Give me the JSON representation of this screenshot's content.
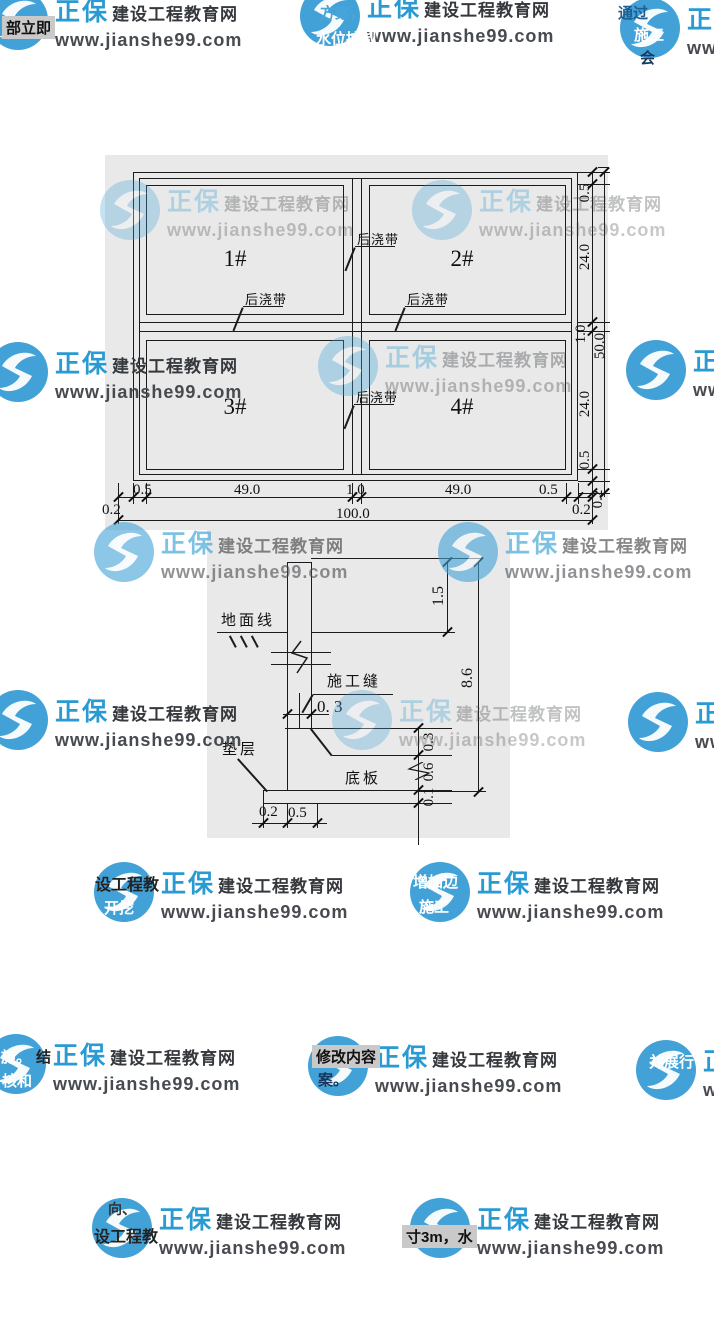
{
  "watermark": {
    "brand": "正保",
    "site": "建设工程教育网",
    "url": "www.jianshe99.com"
  },
  "fragments": {
    "f1": "部立即",
    "f2": "方案，",
    "f3": "水位控制",
    "f4": "通过",
    "f5": "施工",
    "f6": "会",
    "f7": "设工程教",
    "f8": "开挖",
    "f9": "增加边",
    "f10": "施工",
    "f11": "施。",
    "f12": "结",
    "f13": "核和",
    "f14": "修改内容",
    "f15": "案。",
    "f16": "并展行",
    "f17": "向、",
    "f18": "设工程教",
    "f19": "寸3m，水"
  },
  "plan": {
    "quadrants": [
      "1#",
      "2#",
      "3#",
      "4#"
    ],
    "joint_label": "后浇带",
    "dims_bottom": [
      "0.2",
      "0.5",
      "49.0",
      "1.0",
      "49.0",
      "0.5",
      "0.2"
    ],
    "total_bottom": "100.0",
    "dims_right": [
      "0.5",
      "24.0",
      "1.0",
      "24.0",
      "0.5",
      "0.2"
    ],
    "total_right": "50.0"
  },
  "section": {
    "labels": {
      "ground": "地面线",
      "joint": "施工缝",
      "bedding": "垫层",
      "slab": "底板"
    },
    "dims": {
      "wall_width": "0. 3",
      "upper": "1.5",
      "overall": "8.6",
      "haunch": "0.3",
      "slab_thk": "0.6",
      "bedding_thk": "0.1",
      "proj": "0.2",
      "edge": "0.5"
    }
  }
}
